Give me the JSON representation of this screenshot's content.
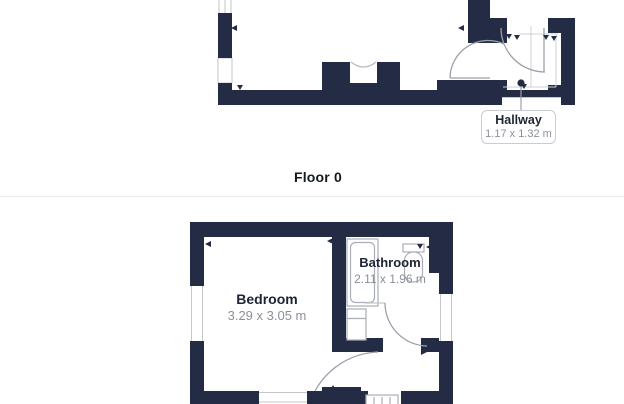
{
  "floor_label": "Floor 0",
  "rooms": {
    "hallway": {
      "name": "Hallway",
      "dims": "1.17 x 1.32 m"
    },
    "bedroom": {
      "name": "Bedroom",
      "dims": "3.29 x 3.05 m"
    },
    "bathroom": {
      "name": "Bathroom",
      "dims": "2.11 x 1.96 m"
    }
  },
  "colors": {
    "wall": "#232c44",
    "door_arc": "#9ba1ab",
    "thin_line": "#c2c6cd",
    "fixture_outline": "#a9aeb7",
    "text_dark": "#1d2433",
    "text_gray": "#8b909b",
    "label_border": "#c9ccd3",
    "divider": "#e9eaeb",
    "background": "#ffffff"
  }
}
